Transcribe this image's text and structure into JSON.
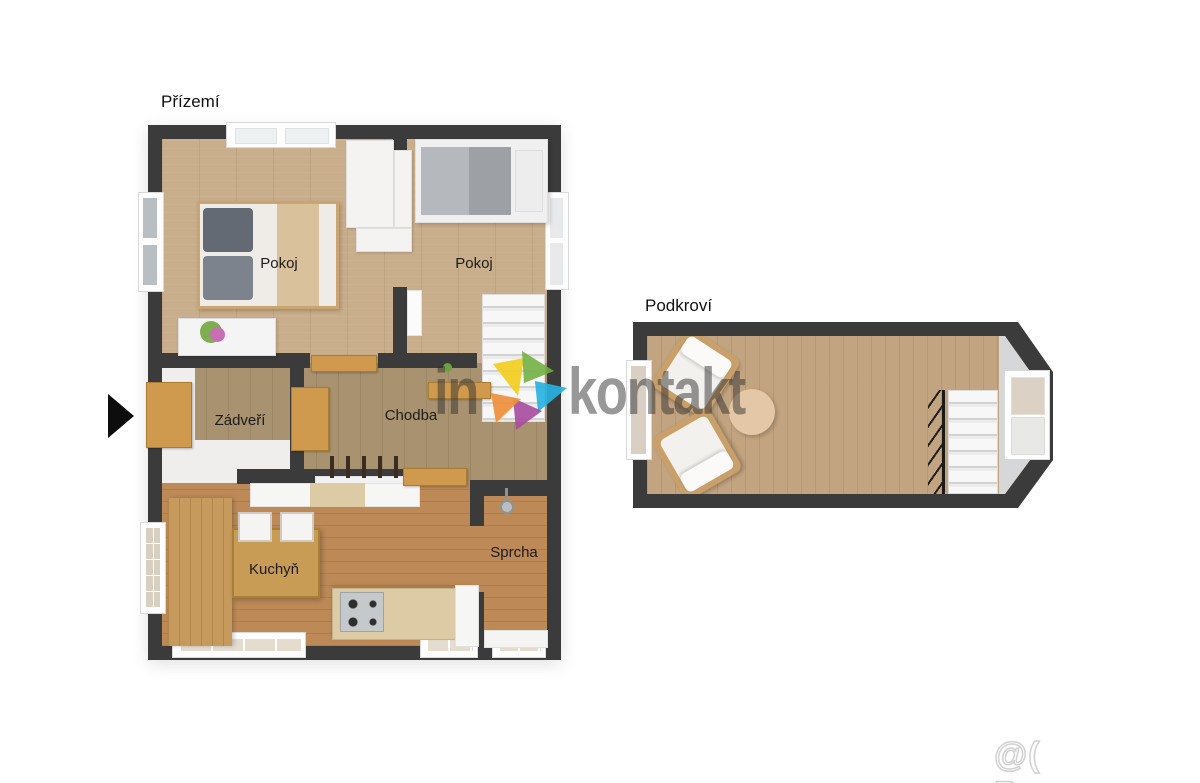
{
  "floors": {
    "ground": {
      "title": "Přízemí",
      "labels": {
        "pokoj_left": "Pokoj",
        "pokoj_right": "Pokoj",
        "zadveri": "Zádveří",
        "chodba": "Chodba",
        "kuchyn": "Kuchyň",
        "sprcha": "Sprcha"
      }
    },
    "attic": {
      "title": "Podkroví"
    }
  },
  "watermark": {
    "left_text": "in",
    "right_text": "kontakt",
    "text_color": "rgba(50,50,50,0.5)",
    "dot_color": "#6aa33d",
    "logo_colors": {
      "yellow": "#f2cd1e",
      "green": "#6faf3f",
      "cyan": "#27b2df",
      "magenta": "#a84da0",
      "orange": "#ef8f3a"
    }
  },
  "credit": {
    "text": "@( Bazos.cz"
  },
  "palette": {
    "wall": "#3b3b3b",
    "floor_bedroom": "#c9ae8b",
    "floor_hall": "#a8926f",
    "floor_kitchen": "#bd8a57",
    "floor_attic": "#c3a480",
    "door_wood": "#cf9a4d",
    "counter_beige": "#ddcba6",
    "stairs_white": "#f2f2f2",
    "pillow_gray": "#646a73",
    "blanket_beige": "#d9c19c"
  }
}
